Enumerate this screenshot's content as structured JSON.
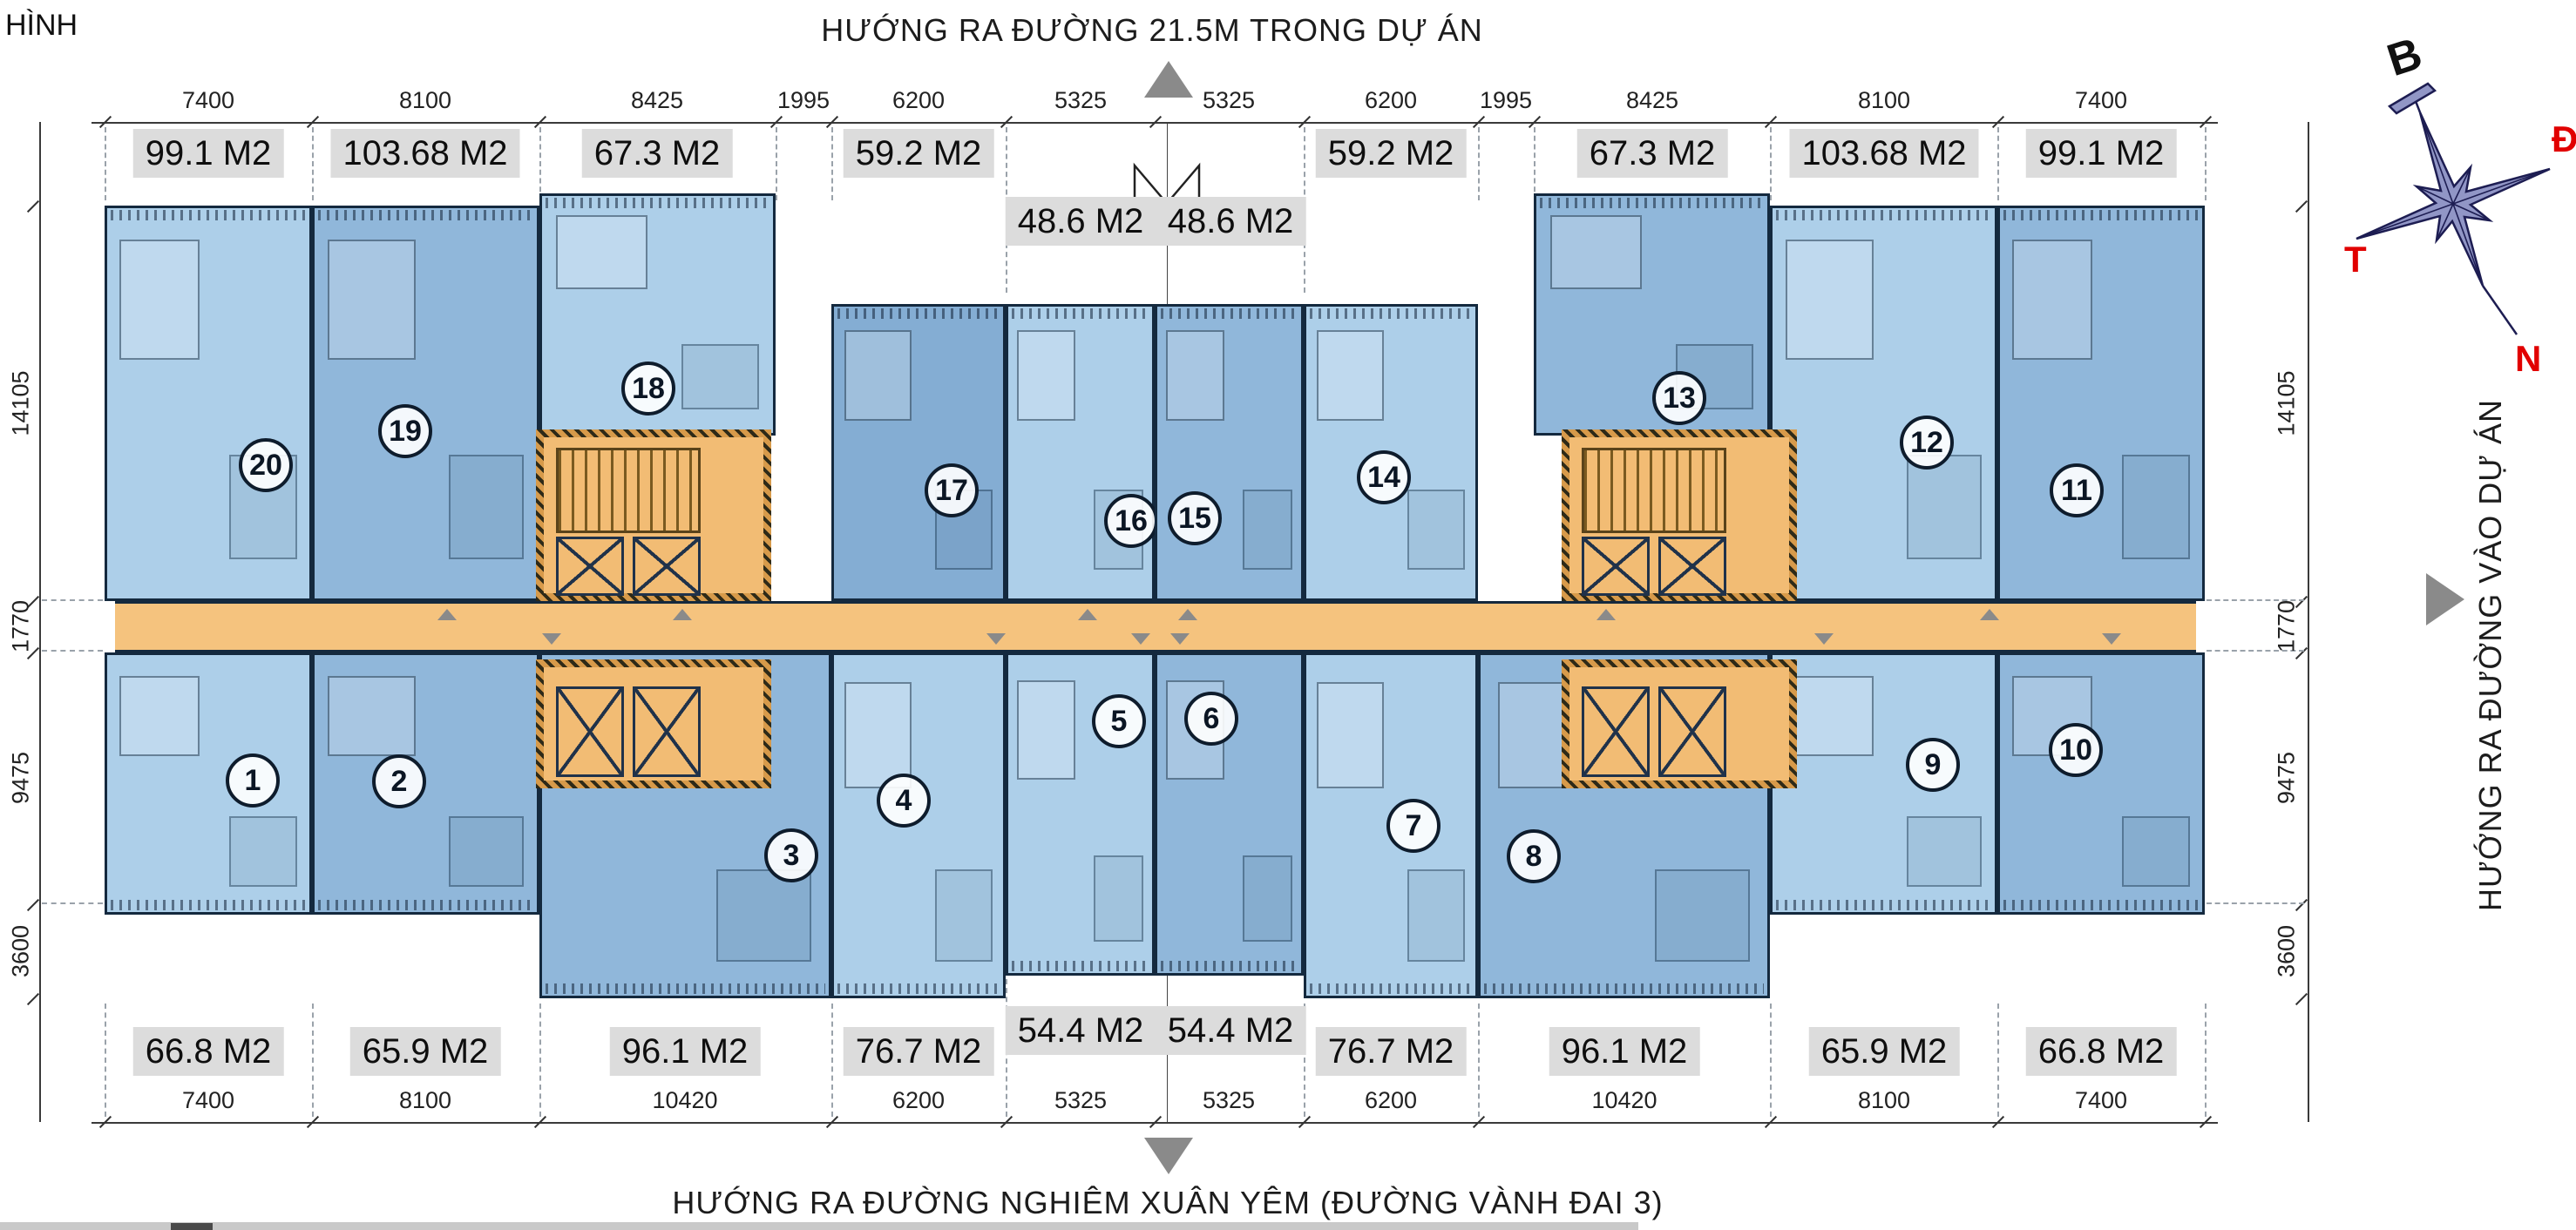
{
  "header": {
    "title_fragment": "HÌNH",
    "top_direction": "HƯỚNG RA ĐƯỜNG 21.5M TRONG DỰ ÁN"
  },
  "footer": {
    "bottom_direction": "HƯỚNG RA ĐƯỜNG NGHIÊM XUÂN YÊM (ĐƯỜNG VÀNH ĐAI 3)"
  },
  "side": {
    "right_direction": "HƯỚNG RA ĐƯỜNG VÀO DỰ ÁN"
  },
  "compass": {
    "north_label": "B",
    "east_label": "Đ",
    "west_label": "T",
    "south_label": "N"
  },
  "units": {
    "top": [
      {
        "number": "20",
        "area": "99.1 M2"
      },
      {
        "number": "19",
        "area": "103.68 M2"
      },
      {
        "number": "18",
        "area": "67.3 M2"
      },
      {
        "number": "17",
        "area": "59.2 M2"
      },
      {
        "number": "16",
        "area": "48.6 M2"
      },
      {
        "number": "15",
        "area": "48.6 M2"
      },
      {
        "number": "14",
        "area": "59.2 M2"
      },
      {
        "number": "13",
        "area": "67.3 M2"
      },
      {
        "number": "12",
        "area": "103.68 M2"
      },
      {
        "number": "11",
        "area": "99.1 M2"
      }
    ],
    "bottom": [
      {
        "number": "1",
        "area": "66.8 M2"
      },
      {
        "number": "2",
        "area": "65.9 M2"
      },
      {
        "number": "3",
        "area": "96.1 M2"
      },
      {
        "number": "4",
        "area": "76.7 M2"
      },
      {
        "number": "5",
        "area": "54.4 M2"
      },
      {
        "number": "6",
        "area": "54.4 M2"
      },
      {
        "number": "7",
        "area": "76.7 M2"
      },
      {
        "number": "8",
        "area": "96.1 M2"
      },
      {
        "number": "9",
        "area": "65.9 M2"
      },
      {
        "number": "10",
        "area": "66.8 M2"
      }
    ]
  },
  "dimensions": {
    "top": [
      "7400",
      "8100",
      "8425",
      "1995",
      "6200",
      "5325",
      "5325",
      "6200",
      "1995",
      "8425",
      "8100",
      "7400"
    ],
    "bottom": [
      "7400",
      "8100",
      "10420",
      "6200",
      "5325",
      "5325",
      "6200",
      "10420",
      "8100",
      "7400"
    ],
    "left": [
      "14105",
      "1770",
      "9475",
      "3600"
    ],
    "right": [
      "14105",
      "1770",
      "9475",
      "3600"
    ]
  },
  "colors": {
    "apartment_light": "#adcfe9",
    "apartment_medium": "#90b7da",
    "apartment_dark": "#84add3",
    "wall": "#14293e",
    "corridor_orange": "#f5c37e",
    "core_orange": "#f2bc74",
    "label_gray": "#dcdcdc",
    "compass_red": "#e10000",
    "arrow_gray": "#8a8a8a",
    "compass_star": "#9196c6"
  }
}
